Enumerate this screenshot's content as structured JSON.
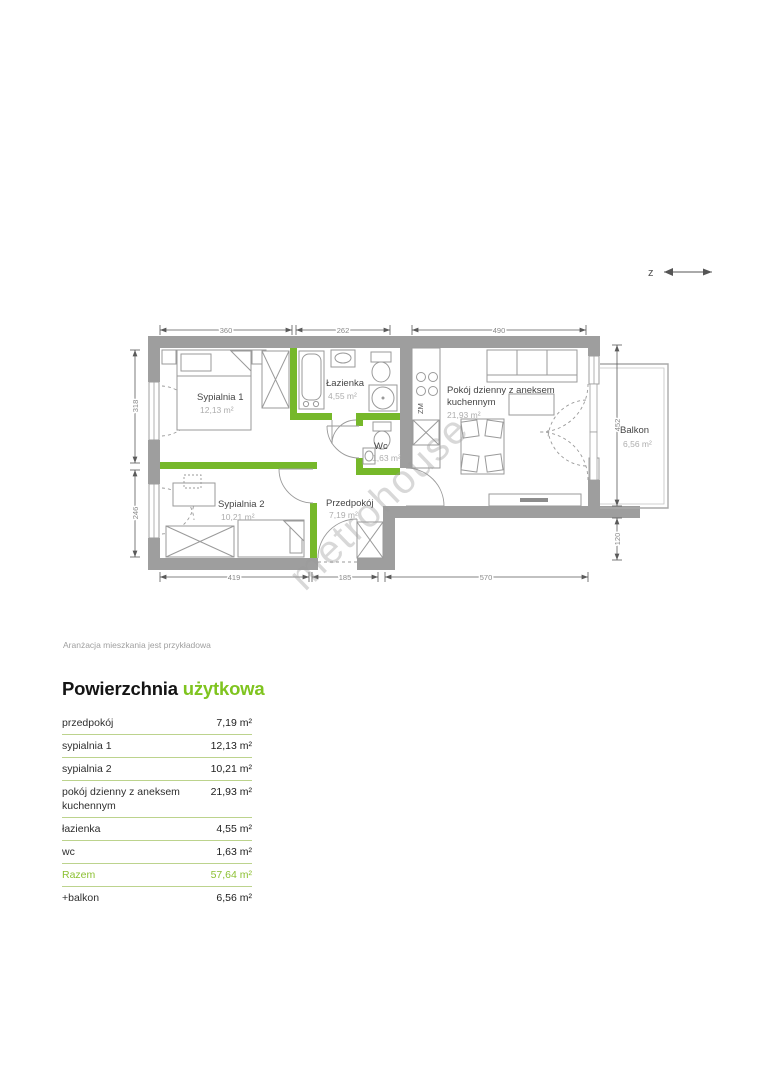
{
  "colors": {
    "accent_green": "#7fc41f",
    "partition_green": "#76b82a",
    "wall_gray": "#9e9e9e",
    "table_line_green": "#bcd38d"
  },
  "plan": {
    "north_label": "z",
    "watermark": "metrohouse",
    "kitchen_appliance_label": "ZM",
    "rooms": {
      "sypialnia1": {
        "name": "Sypialnia 1",
        "area": "12,13 m²"
      },
      "lazienka": {
        "name": "Łazienka",
        "area": "4,55 m²"
      },
      "wc": {
        "name": "Wc",
        "area": "1,63 m²"
      },
      "pokoj": {
        "name_line1": "Pokój dzienny z aneksem",
        "name_line2": "kuchennym",
        "area": "21,93 m²"
      },
      "sypialnia2": {
        "name": "Sypialnia 2",
        "area": "10,21 m²"
      },
      "przedpokoj": {
        "name": "Przedpokój",
        "area": "7,19 m²"
      },
      "balkon": {
        "name": "Balkon",
        "area": "6,56 m²"
      }
    },
    "dimensions": {
      "top": [
        "360",
        "262",
        "490"
      ],
      "left": [
        "318",
        "246"
      ],
      "right": [
        "452",
        "120"
      ],
      "bottom": [
        "419",
        "185",
        "570"
      ]
    }
  },
  "caption": "Aranżacja mieszkania jest przykładowa",
  "heading": {
    "part1": "Powierzchnia",
    "part2": "użytkowa"
  },
  "table": {
    "rows": [
      {
        "label": "przedpokój",
        "value": "7,19 m²"
      },
      {
        "label": "sypialnia 1",
        "value": "12,13 m²"
      },
      {
        "label": "sypialnia 2",
        "value": "10,21 m²"
      },
      {
        "label": "pokój dzienny z aneksem kuchennym",
        "value": "21,93 m²"
      },
      {
        "label": "łazienka",
        "value": "4,55 m²"
      },
      {
        "label": "wc",
        "value": "1,63 m²"
      },
      {
        "label": "Razem",
        "value": "57,64 m²"
      },
      {
        "label": "+balkon",
        "value": "6,56 m²"
      }
    ]
  }
}
